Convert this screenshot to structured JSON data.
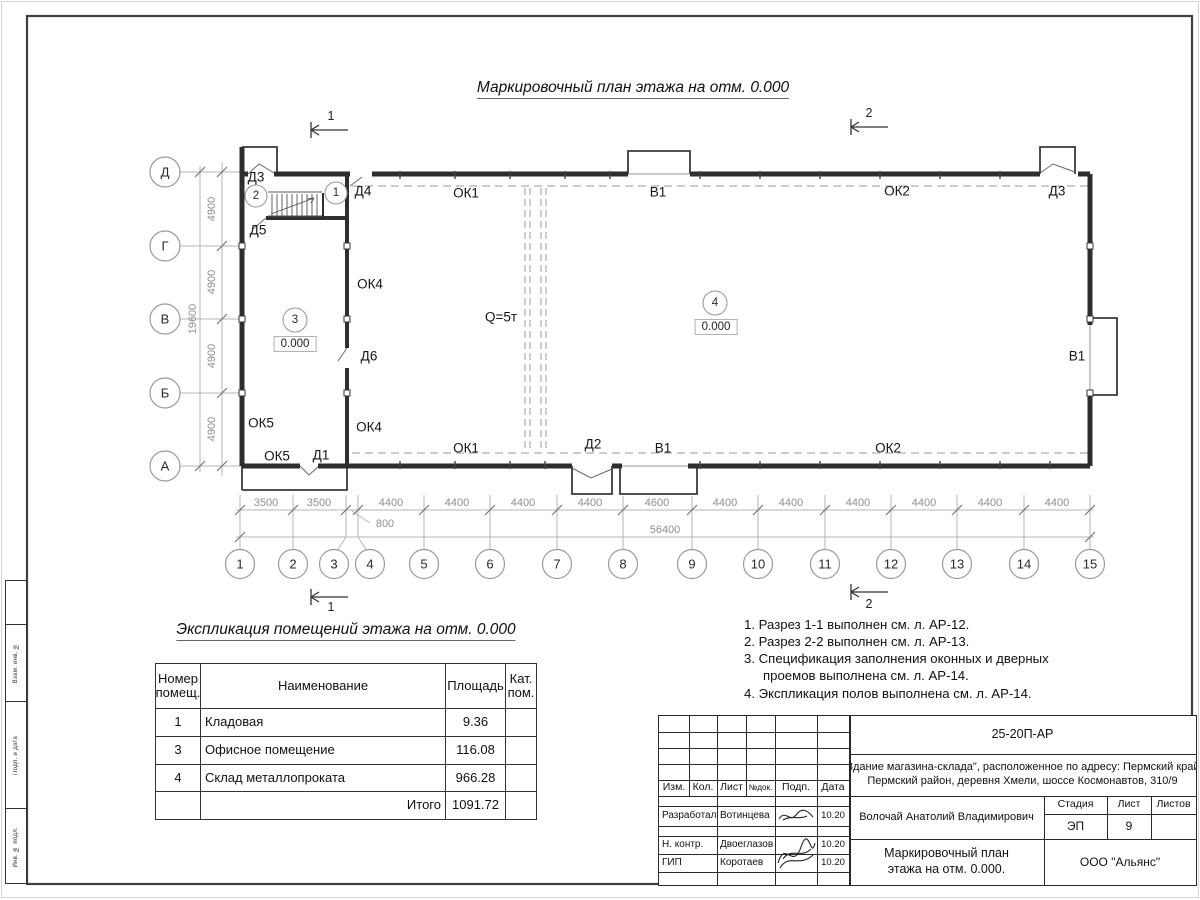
{
  "page": {
    "main_title": "Маркировочный план этажа на отм. 0.000"
  },
  "plan": {
    "axes_rows": [
      "Д",
      "Г",
      "В",
      "Б",
      "А"
    ],
    "axes_cols": [
      "1",
      "2",
      "3",
      "4",
      "5",
      "6",
      "7",
      "8",
      "9",
      "10",
      "11",
      "12",
      "13",
      "14",
      "15"
    ],
    "rooms": [
      "1",
      "2",
      "3",
      "4"
    ],
    "elevation": "0.000",
    "crane_label": "Q=5т",
    "section_marks": [
      "1",
      "2"
    ],
    "dims_vertical": [
      "4900",
      "4900",
      "4900",
      "4900"
    ],
    "dim_vertical_total": "19600",
    "dims_bottom": [
      "3500",
      "3500",
      "4400",
      "4400",
      "4400",
      "4400",
      "4600",
      "4400",
      "4400",
      "4400",
      "4400",
      "4400",
      "4400"
    ],
    "dim_offset": "800",
    "dim_total": "56400",
    "labels": {
      "d3_top_left": "Д3",
      "d4": "Д4",
      "d5": "Д5",
      "d6": "Д6",
      "d1": "Д1",
      "d2": "Д2",
      "d3_top_right": "Д3",
      "ok1_top": "ОК1",
      "ok1_bottom": "ОК1",
      "ok2_top": "ОК2",
      "ok2_bottom": "ОК2",
      "ok4_upper": "ОК4",
      "ok4_lower": "ОК4",
      "ok5_upper": "ОК5",
      "ok5_lower": "ОК5",
      "v1_top": "В1",
      "v1_right": "В1",
      "v1_bottom": "В1"
    }
  },
  "explication": {
    "title": "Экспликация помещений этажа на отм. 0.000",
    "headers": [
      "Номер помещ.",
      "Наименование",
      "Площадь",
      "Кат. пом."
    ],
    "rows": [
      {
        "num": "1",
        "name": "Кладовая",
        "area": "9.36",
        "cat": ""
      },
      {
        "num": "3",
        "name": "Офисное помещение",
        "area": "116.08",
        "cat": ""
      },
      {
        "num": "4",
        "name": "Склад металлопроката",
        "area": "966.28",
        "cat": ""
      }
    ],
    "total_label": "Итого",
    "total_value": "1091.72"
  },
  "notes": [
    "1. Разрез 1-1 выполнен см. л. АР-12.",
    "2. Разрез 2-2 выполнен см. л. АР-13.",
    "3. Спецификация заполнения оконных и дверных проемов выполнена см. л. АР-14.",
    "4. Экспликация полов выполнена см. л. АР-14."
  ],
  "title_block": {
    "doc_number": "25-20П-АР",
    "object_line1": "\"Здание магазина-склада\", расположенное по адресу: Пермский край,",
    "object_line2": "Пермский район, деревня Хмели, шоссе Космонавтов, 310/9",
    "header_cols": [
      "Изм.",
      "Кол.",
      "Лист",
      "№док.",
      "Подп.",
      "Дата"
    ],
    "rows": [
      {
        "role": "Разработал",
        "name": "Вотинцева",
        "date": "10.20"
      },
      {
        "role": "Н. контр.",
        "name": "Двоеглазов",
        "date": "10.20"
      },
      {
        "role": "ГИП",
        "name": "Коротаев",
        "date": "10.20"
      }
    ],
    "author": "Волочай Анатолий Владимирович",
    "drawing_title_line1": "Маркировочный план",
    "drawing_title_line2": "этажа на отм. 0.000.",
    "stage_label": "Стадия",
    "sheet_label": "Лист",
    "sheets_label": "Листов",
    "stage": "ЭП",
    "sheet": "9",
    "sheets": "",
    "company": "ООО \"Альянс\""
  },
  "side_column": {
    "labels": [
      "Взам. инв. №",
      "Подп. и дата",
      "Инв. № подл."
    ]
  }
}
